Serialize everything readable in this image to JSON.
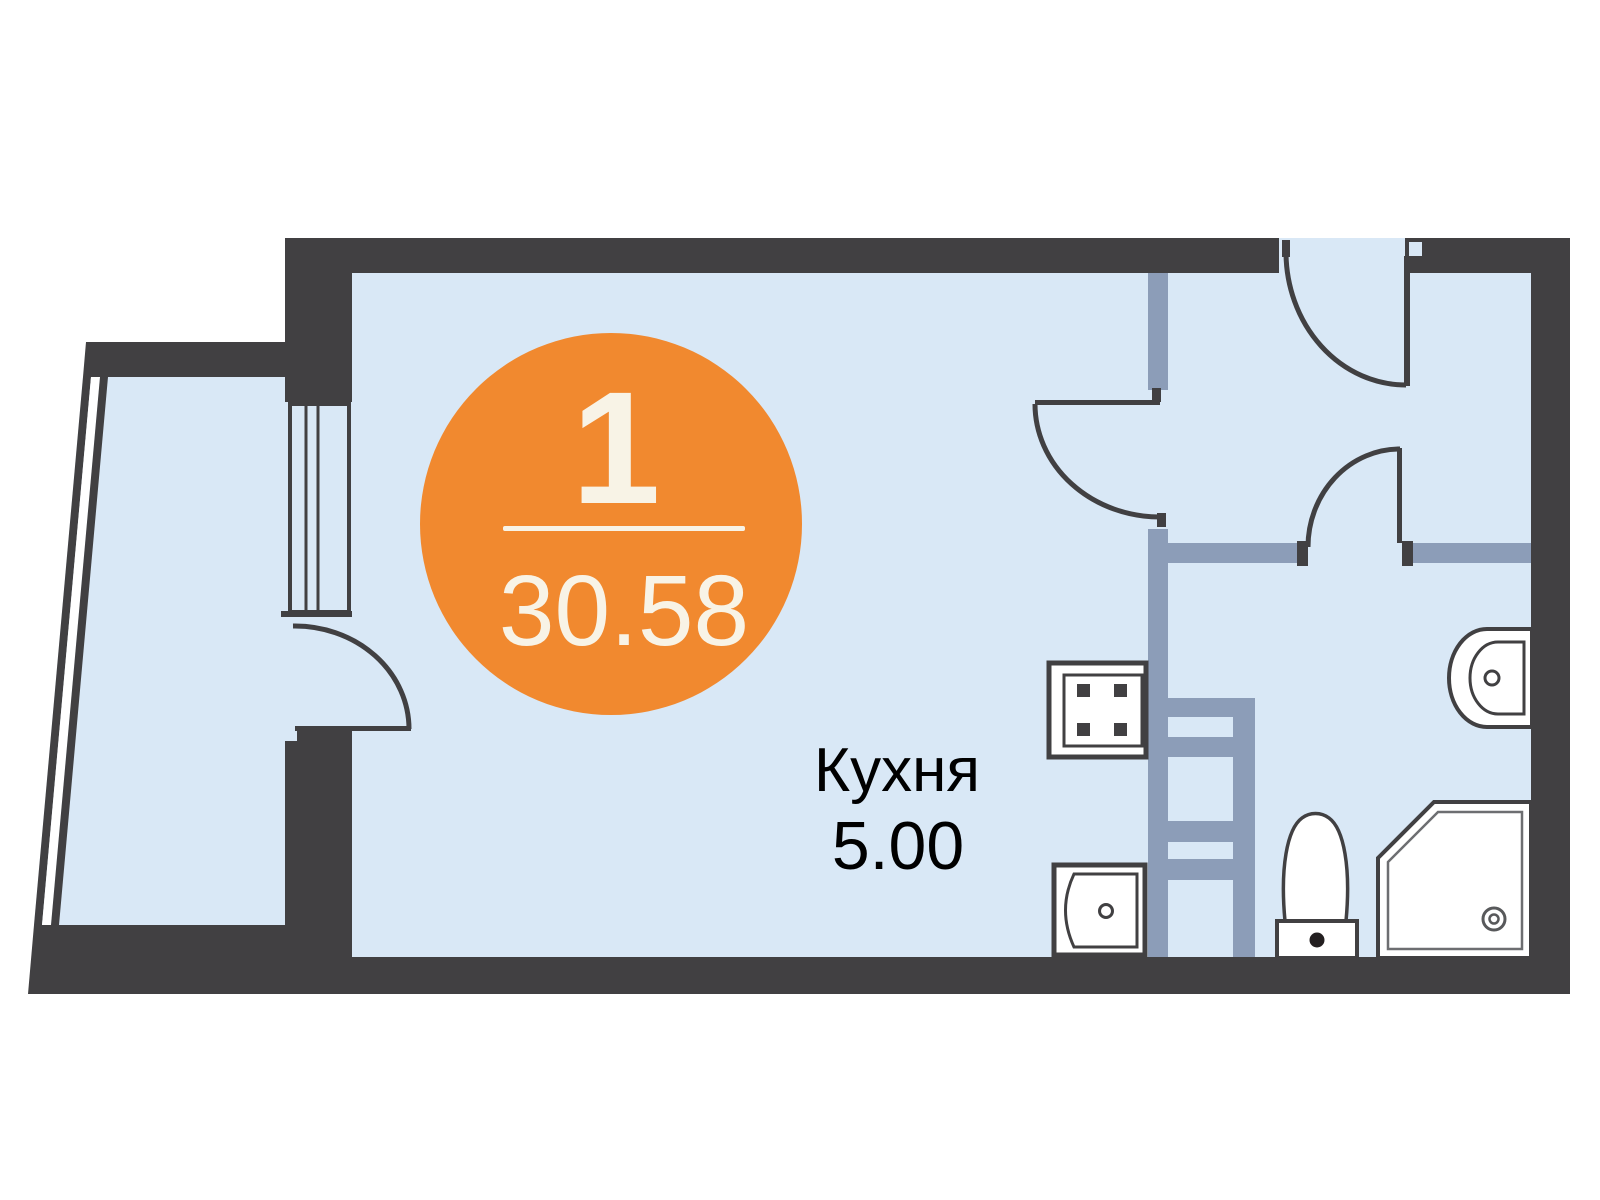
{
  "badge": {
    "rooms_count": "1",
    "total_area": "30.58",
    "fill_color": "#F1892F",
    "text_color": "#F8F3E6"
  },
  "kitchen_label": {
    "name": "Кухня",
    "area": "5.00",
    "text_color": "#000000"
  },
  "colors": {
    "outer_wall_dark": "#414042",
    "interior_wall_gray_blue": "#8C9DB8",
    "floor_light_blue": "#D9E8F6",
    "fixture_outline": "#414042",
    "fixture_inner_gray": "#6D6E71",
    "background": "#FFFFFF"
  },
  "fixtures": [
    "stove-icon",
    "kitchen-sink-icon",
    "bathroom-sink-icon",
    "toilet-icon",
    "shower-icon",
    "ventilation-ladder-icon"
  ]
}
